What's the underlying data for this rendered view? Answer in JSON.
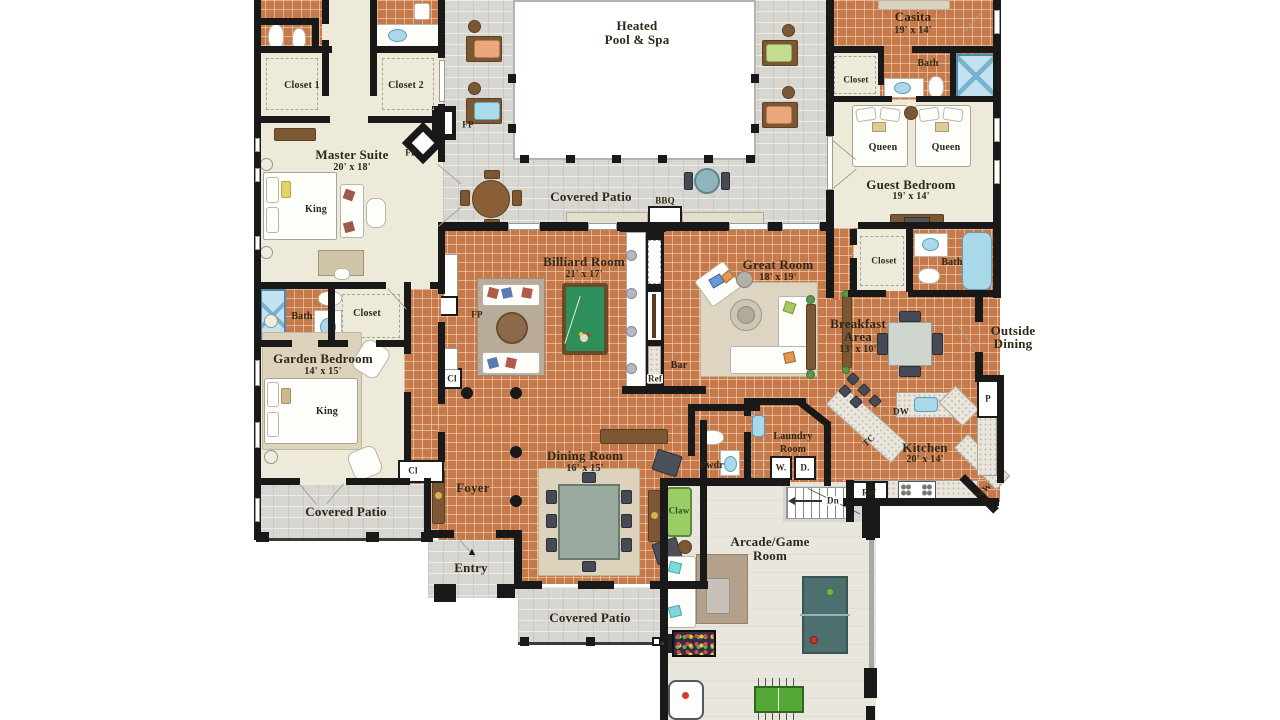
{
  "rooms": {
    "closet1": {
      "name": "Closet 1"
    },
    "closet2": {
      "name": "Closet 2"
    },
    "master_suite": {
      "name": "Master Suite",
      "dims": "20' x 18'"
    },
    "garden_bedroom": {
      "name": "Garden Bedroom",
      "dims": "14' x 15'"
    },
    "garden_bath": {
      "name": "Bath"
    },
    "garden_closet": {
      "name": "Closet"
    },
    "pool": {
      "line1": "Heated",
      "line2": "Pool & Spa"
    },
    "pool_patio": {
      "name": "Covered Patio"
    },
    "casita": {
      "name": "Casita",
      "dims": "19' x 14'"
    },
    "casita_bath": {
      "name": "Bath"
    },
    "casita_closet": {
      "name": "Closet"
    },
    "guest_bedroom": {
      "name": "Guest Bedroom",
      "dims": "19' x 14'"
    },
    "guest_bath": {
      "name": "Bath"
    },
    "guest_closet": {
      "name": "Closet"
    },
    "billiard": {
      "name": "Billiard Room",
      "dims": "21' x 17'"
    },
    "great_room": {
      "name": "Great Room",
      "dims": "18' x 19'"
    },
    "breakfast": {
      "line1": "Breakfast",
      "line2": "Area",
      "dims": "13' x 10'"
    },
    "outside_dining": {
      "line1": "Outside",
      "line2": "Dining"
    },
    "kitchen": {
      "name": "Kitchen",
      "dims": "20' x 14'"
    },
    "laundry": {
      "line1": "Laundry",
      "line2": "Room"
    },
    "pwdr": {
      "name": "Pwdr"
    },
    "bar": {
      "name": "Bar"
    },
    "dining": {
      "name": "Dining Room",
      "dims": "16' x 15'"
    },
    "foyer": {
      "name": "Foyer"
    },
    "entry": {
      "name": "Entry"
    },
    "patio_left": {
      "name": "Covered Patio"
    },
    "patio_bottom": {
      "name": "Covered Patio"
    },
    "arcade": {
      "line1": "Arcade/Game",
      "line2": "Room"
    }
  },
  "fixtures": {
    "king_master": "King",
    "king_garden": "King",
    "queen_left": "Queen",
    "queen_right": "Queen",
    "fp_patio": "FP",
    "fp_master": "FP",
    "fp_billiard": "FP",
    "bbq": "BBQ",
    "ref_bar": "Ref",
    "ref_kitchen": "Ref",
    "dw": "DW",
    "tc": "TC",
    "mw": "MW",
    "pantry": "P",
    "washer": "W.",
    "dryer": "D.",
    "dn": "Dn",
    "claw": "Claw",
    "cl_hall": "Cl",
    "cl_foyer": "Cl",
    "entry_arrow": "▲"
  },
  "colors": {
    "tile_floor": "#c6794a",
    "bedroom_floor": "#edead9",
    "patio_floor": "#d8d6d0",
    "arcade_floor": "#e8e6dd",
    "wall": "#191919",
    "pool_felt": "#2f8f5b",
    "water_blue": "#a9d9e9",
    "label_text": "#2f2718"
  }
}
